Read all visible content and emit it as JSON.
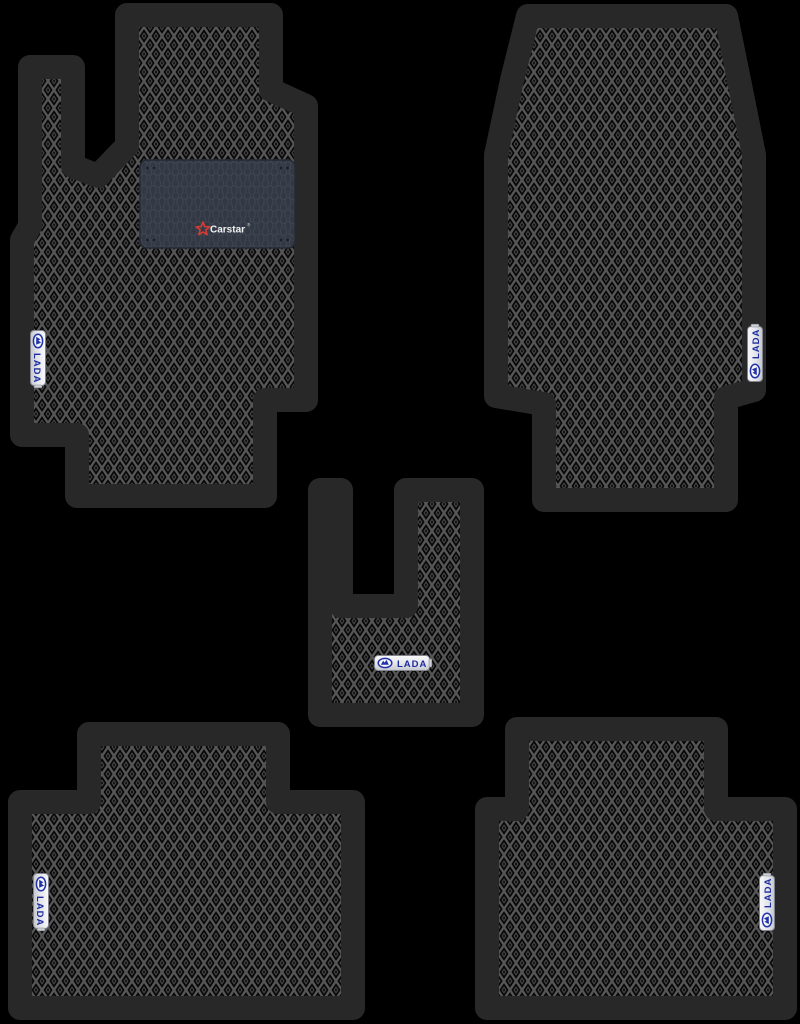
{
  "scene": {
    "description": "Product photo: set of five black EVA car floor mats with rhombus cell pattern on a black background",
    "background_color": "#000000",
    "pieces_count": 5
  },
  "colors": {
    "background": "#000000",
    "mat_cell_black": "#070707",
    "rhombus_grid_gray": "#565656",
    "rhombus_dot_gray": "#454545",
    "edge_trim": "#282828",
    "heel_pad_base": "#323944",
    "heel_pad_cell_line": "#3d4450",
    "badge_face_silver": "#eef0f4",
    "badge_blue": "#1e2d9e",
    "carstar_red": "#d63c36",
    "carstar_text_white": "#f2f2f2"
  },
  "badge": {
    "text": "LADA"
  },
  "heel_pad": {
    "brand": "Carstar",
    "reg_mark": "®"
  },
  "mats": [
    {
      "id": "driver-front",
      "position": "top-left",
      "badge_text": "LADA",
      "badge_orientation": "vertical-left-edge",
      "has_heel_pad": true
    },
    {
      "id": "front-passenger",
      "position": "top-right",
      "badge_text": "LADA",
      "badge_orientation": "vertical-right-edge",
      "has_heel_pad": false
    },
    {
      "id": "center-tunnel",
      "position": "middle-center",
      "badge_text": "LADA",
      "badge_orientation": "horizontal",
      "has_heel_pad": false
    },
    {
      "id": "rear-left",
      "position": "bottom-left",
      "badge_text": "LADA",
      "badge_orientation": "vertical-left-edge",
      "has_heel_pad": false
    },
    {
      "id": "rear-right",
      "position": "bottom-right",
      "badge_text": "LADA",
      "badge_orientation": "vertical-right-edge",
      "has_heel_pad": false
    }
  ]
}
